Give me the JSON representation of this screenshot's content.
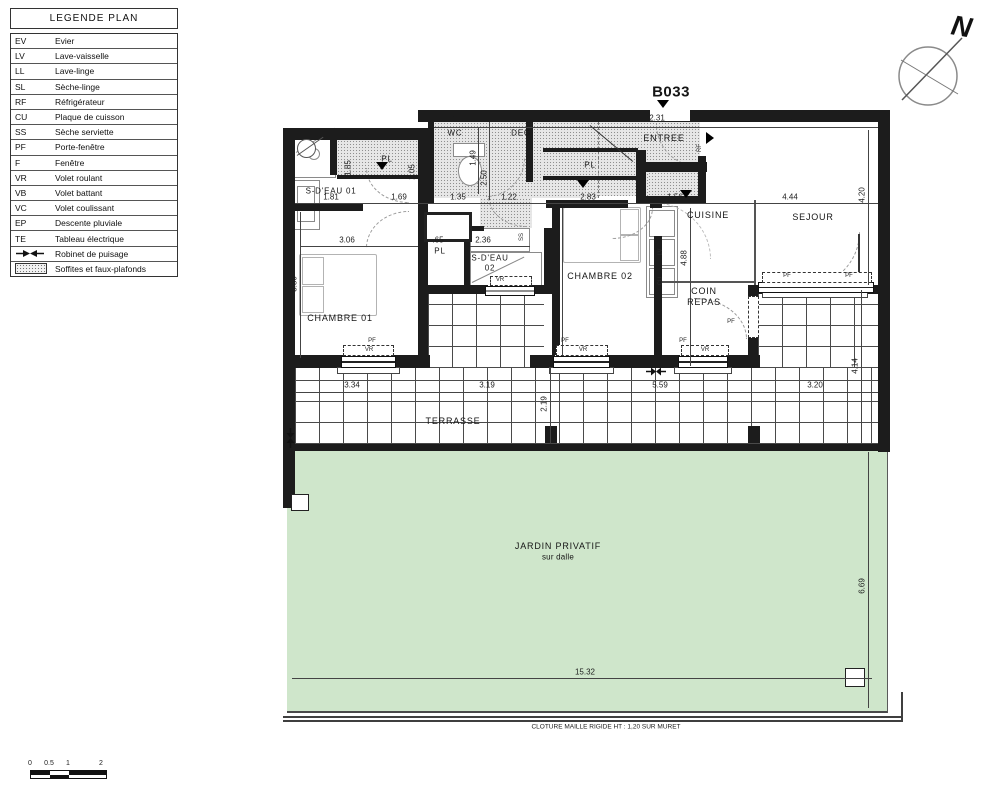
{
  "plan_id": "B033",
  "legend": {
    "title": "LEGENDE PLAN",
    "rows": [
      {
        "abbr": "EV",
        "label": "Evier"
      },
      {
        "abbr": "LV",
        "label": "Lave-vaisselle"
      },
      {
        "abbr": "LL",
        "label": "Lave-linge"
      },
      {
        "abbr": "SL",
        "label": "Sèche-linge"
      },
      {
        "abbr": "RF",
        "label": "Réfrigérateur"
      },
      {
        "abbr": "CU",
        "label": "Plaque de cuisson"
      },
      {
        "abbr": "SS",
        "label": "Sèche serviette"
      },
      {
        "abbr": "PF",
        "label": "Porte-fenêtre"
      },
      {
        "abbr": "F",
        "label": "Fenêtre"
      },
      {
        "abbr": "VR",
        "label": "Volet roulant"
      },
      {
        "abbr": "VB",
        "label": "Volet battant"
      },
      {
        "abbr": "VC",
        "label": "Volet coulissant"
      },
      {
        "abbr": "EP",
        "label": "Descente pluviale"
      },
      {
        "abbr": "TE",
        "label": "Tableau électrique"
      },
      {
        "abbr": "",
        "label": "Robinet de puisage"
      },
      {
        "abbr": "",
        "label": "Soffites et faux-plafonds"
      }
    ]
  },
  "compass": {
    "north": "N"
  },
  "rooms": {
    "sdeau01": "S-D'EAU 01",
    "wc": "WC",
    "deg": "DEG",
    "entree": "ENTREE",
    "cuisine": "CUISINE",
    "sejour": "SEJOUR",
    "coin1": "COIN",
    "coin2": "REPAS",
    "chambre01": "CHAMBRE 01",
    "chambre02": "CHAMBRE 02",
    "sdeau02a": "S-D'EAU",
    "sdeau02b": "02",
    "terrasse": "TERRASSE",
    "jardin1": "JARDIN PRIVATIF",
    "jardin2": "sur dalle"
  },
  "tags": {
    "vr": "VR",
    "pf": "PF",
    "pl": "PL",
    "niche": "niche",
    "lv": "LV",
    "cu": "CU",
    "ss": "SS",
    "rf": "RF"
  },
  "dims": {
    "wc_w": "1.30",
    "deg_w": "3.45",
    "entree_w": "2.31",
    "sejour_top": "4.49",
    "sdeau01_a": "1.81",
    "sdeau01_b": "1.69",
    "niche_w": "1.35",
    "corr_w": "1.22",
    "chambre02_w": "2.83",
    "cuisine_w": "1.56",
    "sejour_w": "4.44",
    "wc_h": "1.49",
    "deg_h": "2.50",
    "sdeau01_h1": "1.85",
    "sdeau01_h2": "2.05",
    "sejour_h": "4.20",
    "chambre02_h": "5.20",
    "cuisine_h": "4.88",
    "chambre01_h": "3.80",
    "chambre01_w": "3.06",
    "pl_w": ".65",
    "sdeau02_w": "2.36",
    "terrasse_a": "3.34",
    "terrasse_b": "3.19",
    "terrasse_c": "5.59",
    "terrasse_d": "3.20",
    "terrasse_h": "2.19",
    "terrasse_h2": "4.14",
    "jardin_h": "6.69",
    "jardin_w": "15.32"
  },
  "footer": {
    "fence_note": "CLOTURE MAILLE RIGIDE HT : 1,20 SUR MURET"
  },
  "scalebar": {
    "t0": "0",
    "t05": "0.5",
    "t1": "1",
    "t2": "2"
  },
  "colors": {
    "wall": "#1c1c1c",
    "jardin": "#cfe6cb",
    "hatch": "#e7e7e7"
  }
}
